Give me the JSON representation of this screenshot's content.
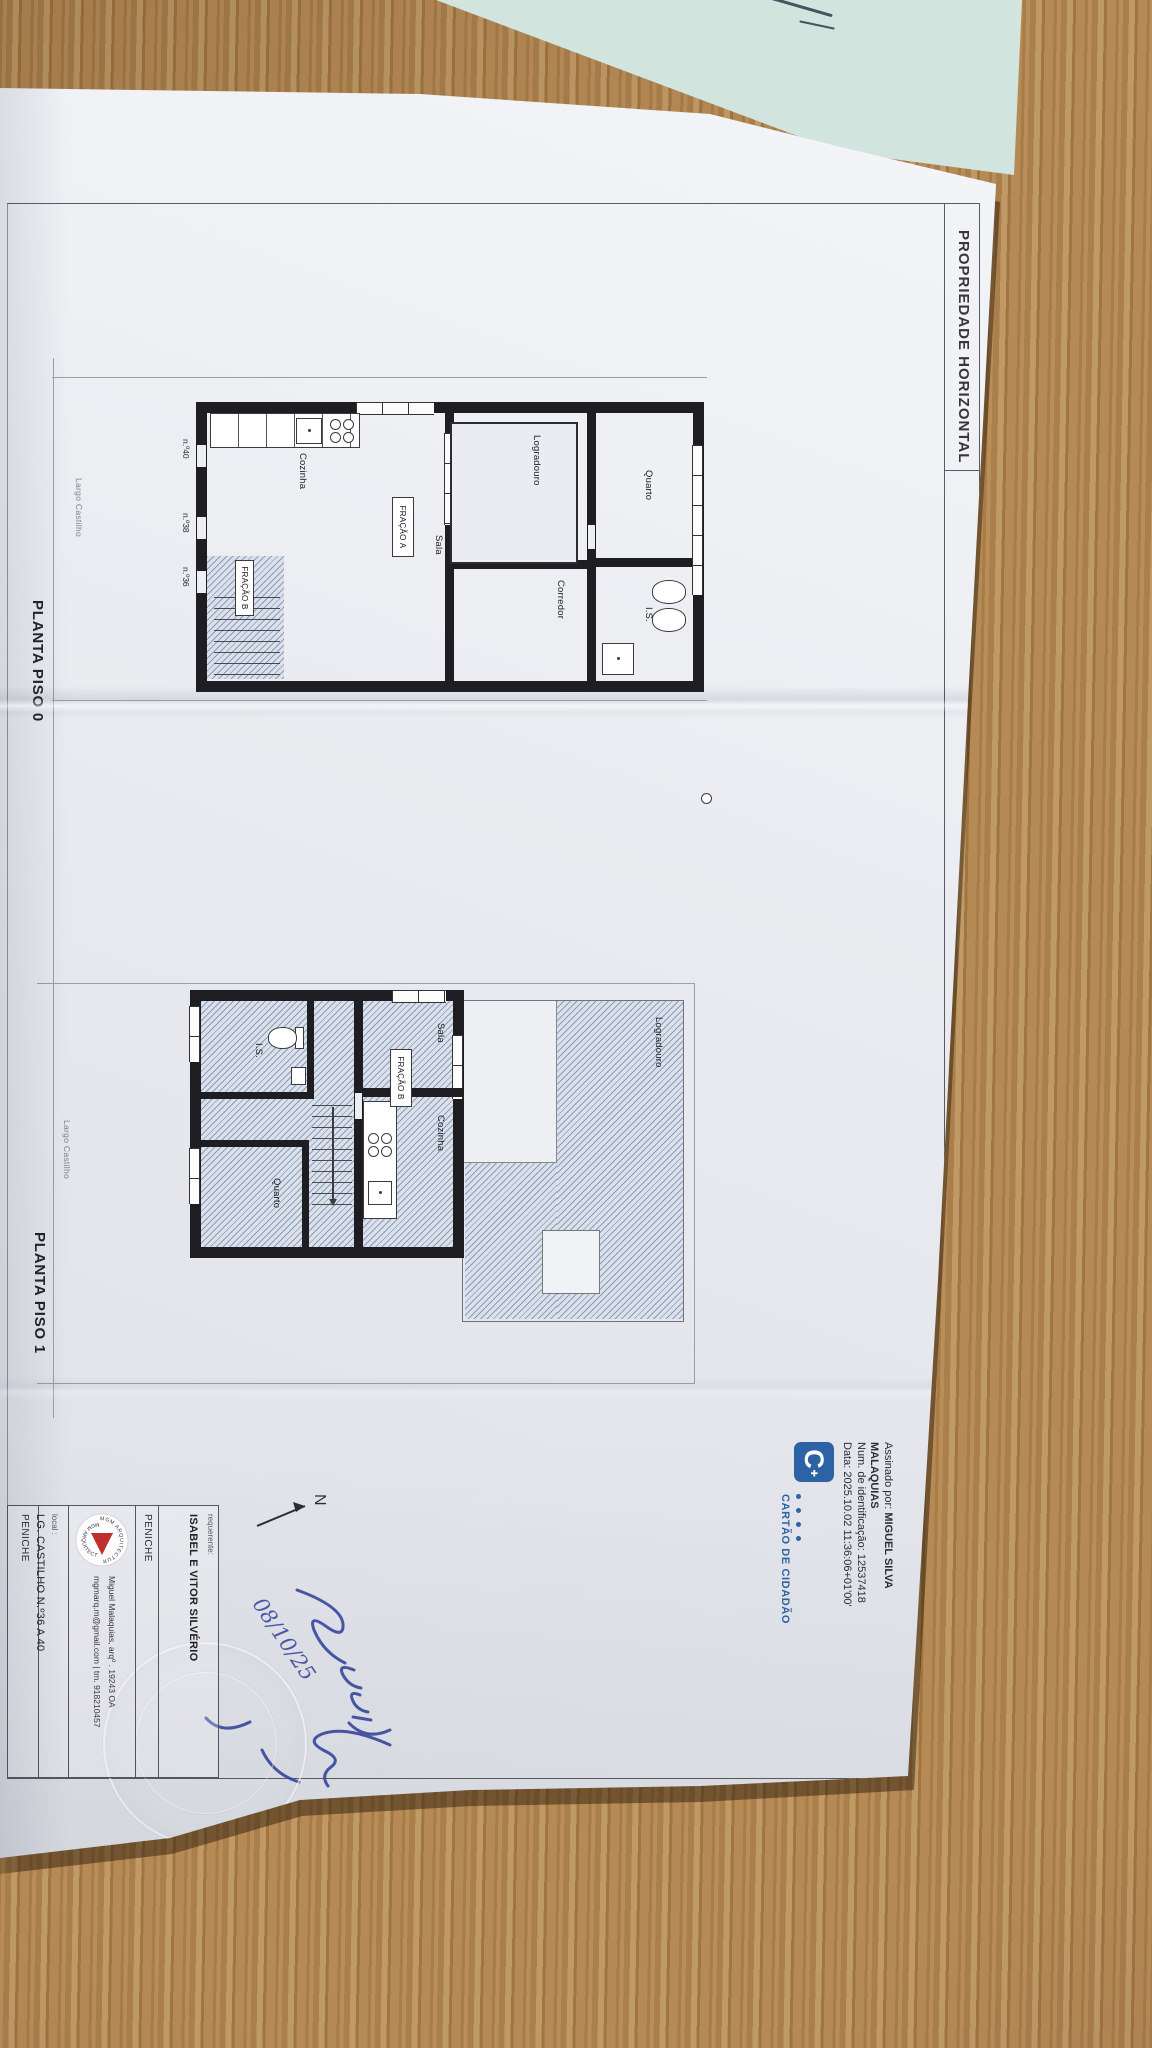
{
  "header": {
    "title": "PROPRIEDADE HORIZONTAL",
    "file_ref": "2025.EXP.E.01.20067 - 02-10-2025"
  },
  "plan_piso0": {
    "caption": "PLANTA PISO 0",
    "street_label": "Largo Castilho",
    "rooms": {
      "quarto": "Quarto",
      "is": "I.S.",
      "corredor": "Corredor",
      "logradouro": "Logradouro",
      "sala": "Sala",
      "cozinha": "Cozinha"
    },
    "unit_labels": {
      "fracao_a": "FRAÇÃO A",
      "fracao_b": "FRAÇÃO B"
    },
    "door_numbers": [
      "n.º40",
      "n.º38",
      "n.º36"
    ]
  },
  "plan_piso1": {
    "caption": "PLANTA PISO 1",
    "street_label": "Largo Castilho",
    "rooms": {
      "logradouro": "Logradouro",
      "sala": "Sala",
      "cozinha": "Cozinha",
      "is": "I.S.",
      "quarto": "Quarto"
    },
    "unit_labels": {
      "fracao_b": "FRAÇÃO B"
    }
  },
  "digital_signature": {
    "signed_by_prefix": "Assinado por: ",
    "signed_by_name1": "MIGUEL SILVA",
    "signed_by_name2": "MALAQUIAS",
    "id_line": "Num. de identificação: 12537418",
    "date_line": "Data: 2025.10.02 11:36:06+01'00'",
    "brand": "CARTÃO DE CIDADÃO",
    "logo_letter": "C"
  },
  "title_block": {
    "requerente_label": "requerente:",
    "requerente_name": "ISABEL E VITOR SILVÉRIO",
    "requerente_city": "PENICHE",
    "architect_credit": "Miguel Malaquias, arqº  .  19243 OA",
    "architect_contact": "mgmarq.m@gmail.com  |  tm. 918210457",
    "mgm_arc_text": "MGM ARQUITECTURA",
    "local_label": "local :",
    "local_address": "LG. CASTILHO N.º36 A 40",
    "local_city": "PENICHE"
  },
  "annotations": {
    "handwritten_date": "08/10/25",
    "north_label": "N"
  },
  "colors": {
    "cc_blue": "#2d63a5",
    "ink_blue": "#3b4aa0",
    "mgm_red": "#c03030",
    "hatch_blue": "#93a5c4",
    "wall_black": "#1d1d22",
    "wood_brown": "#b08549",
    "cyan_sheet": "#c8ded7"
  }
}
